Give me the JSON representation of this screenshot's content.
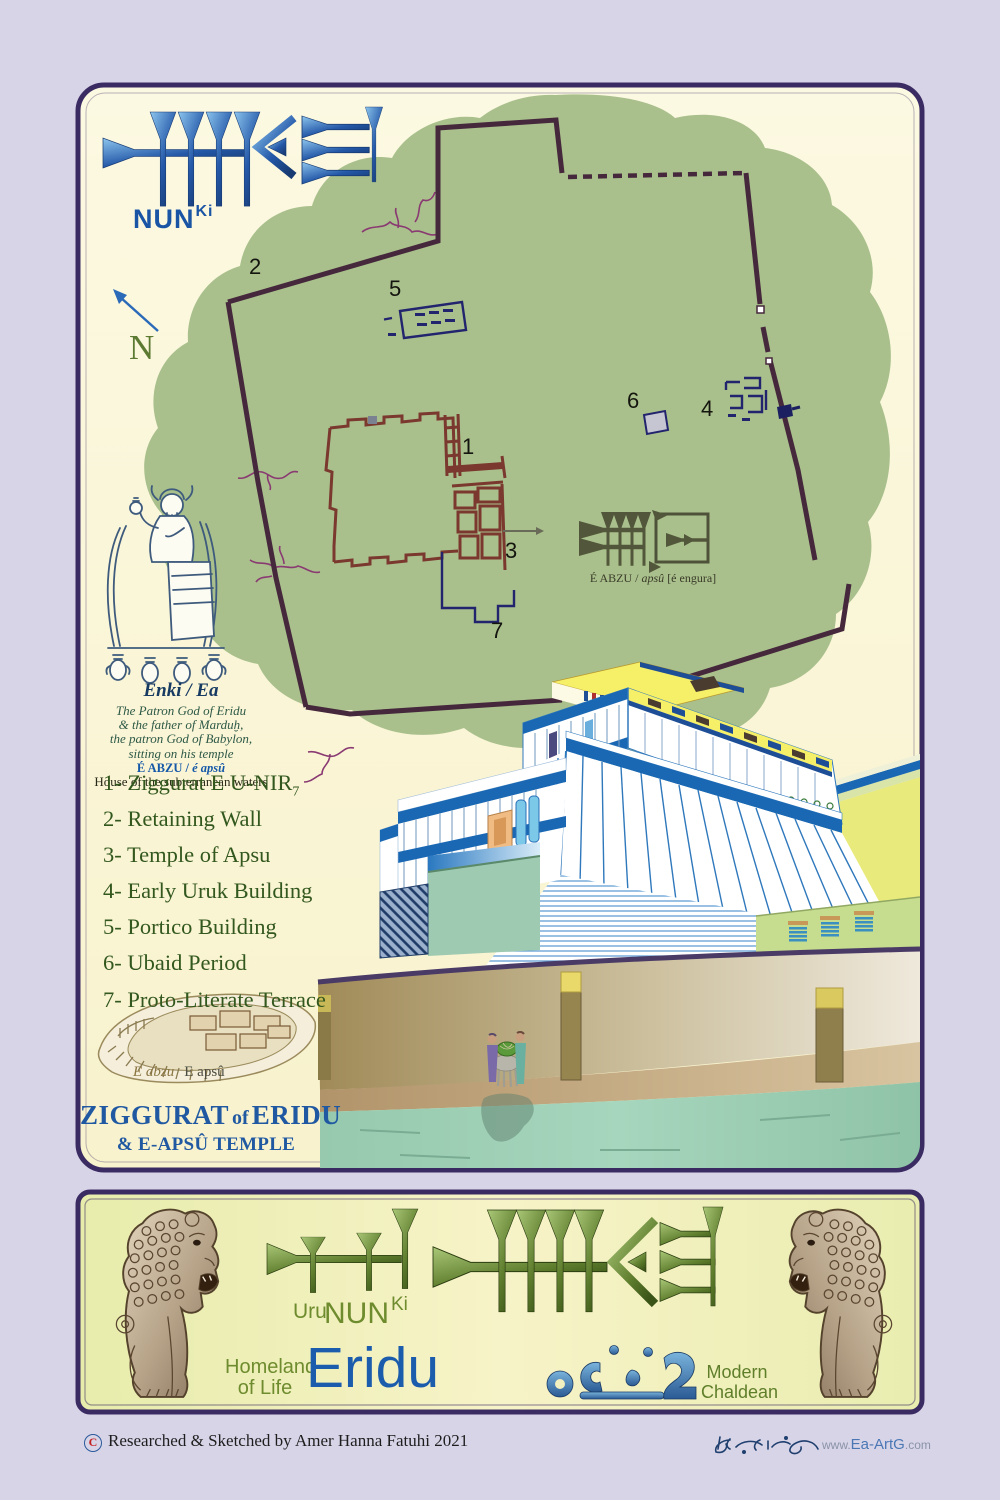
{
  "poster": {
    "cuneiform_label": {
      "nun": "NUN",
      "ki": "Ki"
    },
    "north": "N",
    "map": {
      "markers": [
        "1",
        "2",
        "3",
        "4",
        "5",
        "6",
        "7"
      ],
      "eabzu_prefix": "É ABZU / ",
      "eabzu_italic": "apsû",
      "eabzu_suffix": " [é engura]"
    },
    "enki": {
      "title": "Enki / Ea",
      "line1": "The Patron God of Eridu",
      "line2": "& the father of Marduḫ,",
      "line3": "the patron God of Babylon,",
      "line4": "sitting on his temple",
      "temple_bold": "É ABZU / ",
      "temple_italic": "é apsû",
      "subtitle": "House of the subterranean waters"
    },
    "legend": [
      {
        "num": "1-",
        "label": "Ziggurat E U-NIR",
        "sub": "7"
      },
      {
        "num": "2-",
        "label": "Retaining Wall",
        "sub": ""
      },
      {
        "num": "3-",
        "label": "Temple of Apsu",
        "sub": ""
      },
      {
        "num": "4-",
        "label": "Early Uruk Building",
        "sub": ""
      },
      {
        "num": "5-",
        "label": "Portico Building",
        "sub": ""
      },
      {
        "num": "6-",
        "label": "Ubaid Period",
        "sub": ""
      },
      {
        "num": "7-",
        "label": "Proto-Literate Terrace",
        "sub": ""
      }
    ],
    "inset_italic": "E abzu",
    "inset_roman": "E apsû",
    "title_word1": "ZIGGURAT",
    "title_of": "of",
    "title_word2": "ERIDU",
    "title_line2": "& E-APSÛ TEMPLE"
  },
  "banner": {
    "uru": "Uru",
    "nun": "NUN",
    "ki": "Ki",
    "homeland1": "Homeland",
    "homeland2": "of Life",
    "eridu": "Eridu",
    "modern1": "Modern",
    "modern2": "Chaldean"
  },
  "footer": {
    "copyright": "C",
    "credit": "Researched & Sketched by Amer Hanna Fatuhi 2021",
    "www": "www.",
    "site": "Ea-ArtG",
    "com": ".com"
  },
  "colors": {
    "accent_blue": "#1b5cad",
    "legend_green": "#33581e",
    "banner_green": "#6e8c2e",
    "panel_border": "#3b2b63"
  }
}
